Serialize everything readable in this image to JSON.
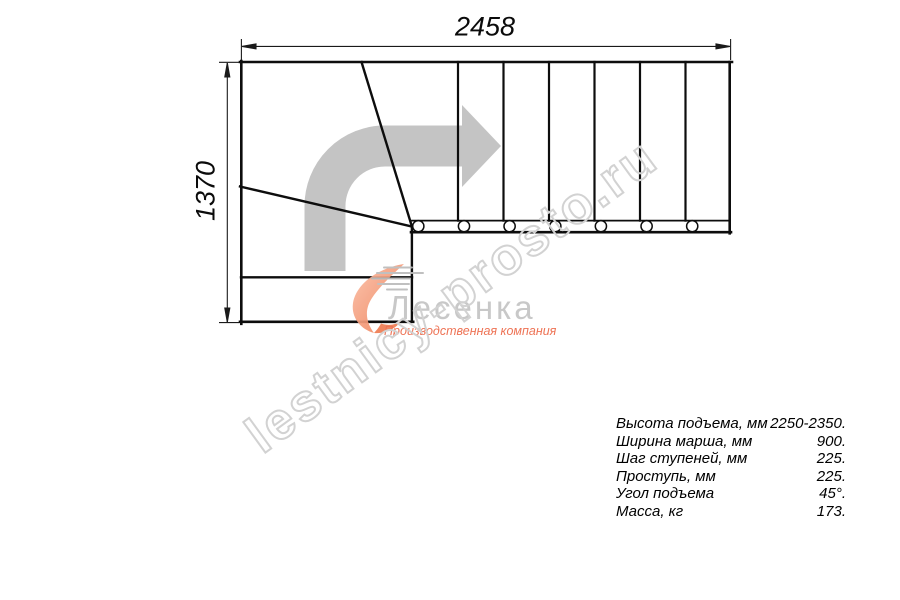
{
  "drawing": {
    "dimension_top": "2458",
    "dimension_left": "1370"
  },
  "specs": {
    "rows": [
      {
        "label": "Высота подъема, мм",
        "value": "2250-2350."
      },
      {
        "label": "Ширина марша, мм",
        "value": "900."
      },
      {
        "label": "Шаг ступеней, мм",
        "value": "225."
      },
      {
        "label": "Проступь, мм",
        "value": "225."
      },
      {
        "label": "Угол подъема",
        "value": "45°."
      },
      {
        "label": "Масса, кг",
        "value": "173."
      }
    ]
  },
  "watermark": {
    "text": "lestnicy-prosto.ru"
  },
  "logo": {
    "name": "Лесенка",
    "subtitle": "Производственная компания"
  },
  "colors": {
    "line": "#0d0d0d",
    "arrow_gray": "#c4c4c4",
    "watermark_gray": "#d2d2d2",
    "logo_gray": "#c8c8c8",
    "logo_orange": "#ee7355"
  }
}
